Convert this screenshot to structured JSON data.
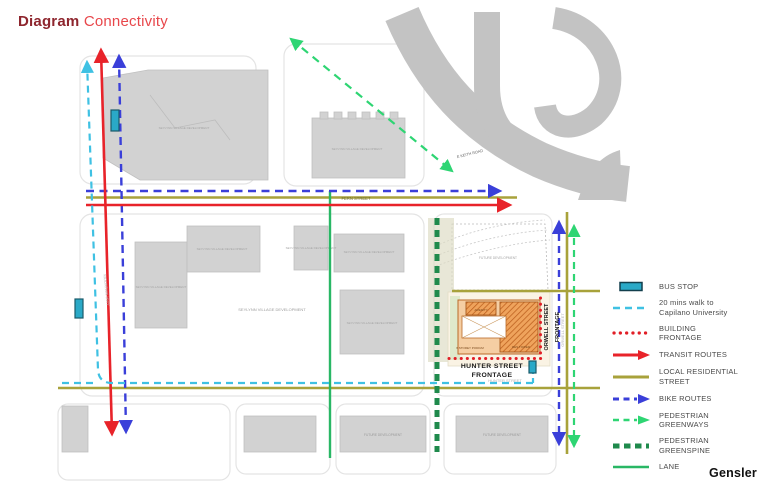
{
  "title": {
    "word_bold": "Diagram",
    "word_regular": "Connectivity"
  },
  "brand": "Gensler",
  "map": {
    "streets": {
      "fern": "FERN STREET",
      "hunter": "HUNTER STREET",
      "mountain_hwy": "MOUNTAIN HWY",
      "orwell": "ORWELL STREET",
      "keith": "E KEITH ROAD"
    },
    "site": {
      "frontage_south_line1": "HUNTER STREET",
      "frontage_south_line2": "FRONTAGE",
      "frontage_east_line1": "ORWELL STREET",
      "frontage_east_line2": "FRONTAGE",
      "amenity": "AMENITY",
      "podium": "6 STOREY PODIUM",
      "tower": "RES TOWER"
    },
    "areas": {
      "seylynn": "SEYLYNN VILLAGE DEVELOPMENT",
      "future_dev": "FUTURE DEVELOPMENT"
    }
  },
  "legend": {
    "items": [
      {
        "key": "bus-stop",
        "line1": "BUS STOP"
      },
      {
        "key": "capilano-walk",
        "line1": "20 mins walk to",
        "line2": "Capilano University"
      },
      {
        "key": "building-frontage",
        "line1": "BUILDING",
        "line2": "FRONTAGE"
      },
      {
        "key": "transit-routes",
        "line1": "TRANSIT ROUTES"
      },
      {
        "key": "local-residential",
        "line1": "LOCAL RESIDENTIAL",
        "line2": "STREET"
      },
      {
        "key": "bike-routes",
        "line1": "BIKE ROUTES"
      },
      {
        "key": "pedestrian-greenways",
        "line1": "PEDESTRIAN",
        "line2": "GREENWAYS"
      },
      {
        "key": "pedestrian-greenspine",
        "line1": "PEDESTRIAN",
        "line2": "GREENSPINE"
      },
      {
        "key": "lane",
        "line1": "LANE"
      }
    ]
  },
  "colors": {
    "red": "#E8232A",
    "blue": "#3A3FD9",
    "cyan": "#3FC1E3",
    "olive": "#A8A23B",
    "green_light": "#2ED573",
    "green_lane": "#29B765",
    "green_spine": "#1F8A4C",
    "teal_fill": "#2AA9C7",
    "building_gray": "#D2D2D2",
    "highway_gray": "#C3C3C3",
    "podium_orange": "#F5CEA3",
    "tower_orange": "#EFA35C"
  }
}
